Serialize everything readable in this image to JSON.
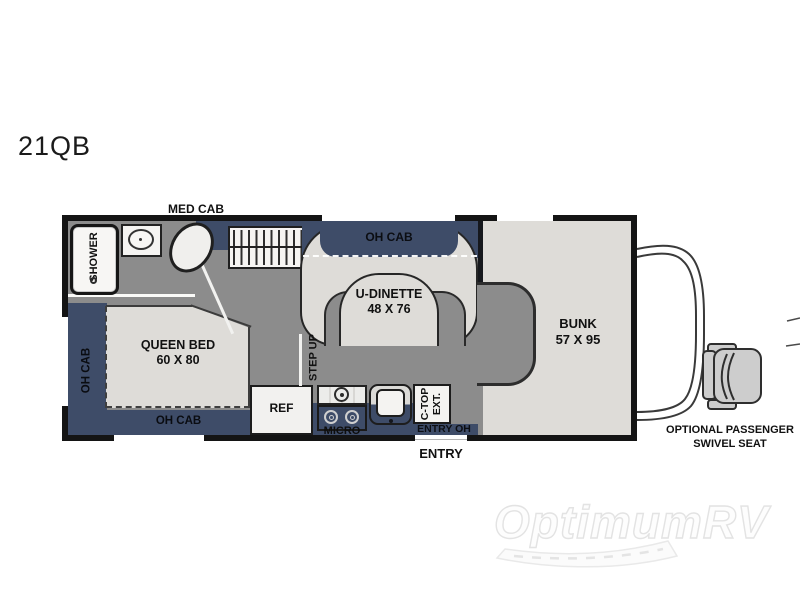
{
  "colors": {
    "navy": "#3e4c68",
    "floor": "#8c8c8c",
    "surface": "#dedcd8",
    "border": "#141414",
    "white_fixture": "#f5f4f2",
    "seat_gray": "#cdcdcd"
  },
  "model": {
    "label": "21QB"
  },
  "plan": {
    "top_label": "MED CAB",
    "bottom_label": "ENTRY",
    "areas": {
      "shower": "SHOWER",
      "oh_cab_top": "OH CAB",
      "u_dinette": {
        "line1": "U-DINETTE",
        "line2": "48 X 76"
      },
      "step_up": "STEP UP",
      "bunk": {
        "line1": "BUNK",
        "line2": "57 X 95"
      },
      "queen_bed": {
        "line1": "QUEEN BED",
        "line2": "60 X 80"
      },
      "oh_cab_left": "OH CAB",
      "oh_cab_bottom": "OH CAB",
      "ref": "REF",
      "micro": "MICRO",
      "ctop": {
        "line1": "C-TOP",
        "line2": "EXT."
      },
      "entry_oh": "ENTRY OH"
    }
  },
  "annotation": {
    "line1": "OPTIONAL PASSENGER",
    "line2": "SWIVEL SEAT"
  },
  "watermark": {
    "text": "OptimumRV"
  }
}
